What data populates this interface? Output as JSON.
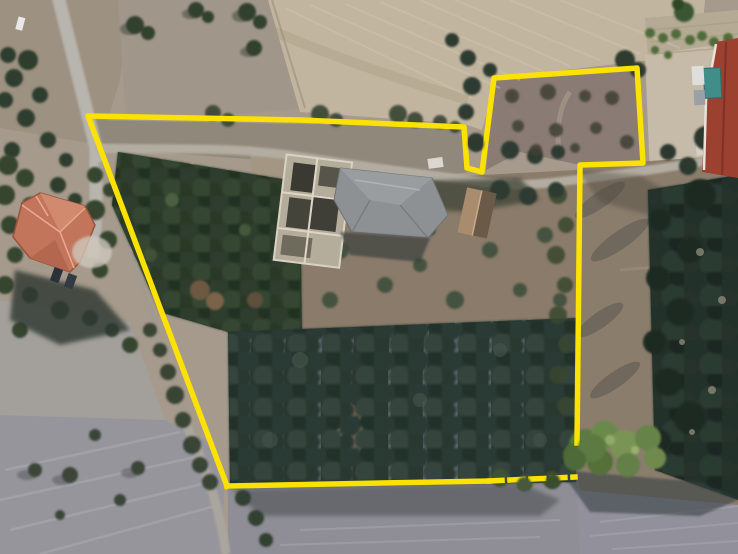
{
  "scene": {
    "type": "aerial-satellite-photo",
    "title": "Aerial view of rural land parcel with yellow boundary overlay",
    "width_px": 738,
    "height_px": 554
  },
  "boundary": {
    "color": "#fbe204",
    "stroke_width": 5.5,
    "dash_pattern": "13 8",
    "main_points": "227,486 88,116 300,120 464,127 467,168 482,172 494,78 637,68 643,163 580,165 577,443",
    "bottom_points": "227,486 489,481",
    "bottom_obscured_points": "489,481 575,477"
  },
  "features": {
    "house": {
      "label": "terracotta-roof-house",
      "roof_color": "#c3755b"
    },
    "ruin": {
      "label": "ruined-stone-building",
      "wall_color": "#b5ad9c"
    },
    "barn": {
      "label": "grey-hip-roof-building",
      "roof_color": "#8e9194"
    },
    "outbuilding": {
      "label": "small-tan-roof-outbuilding",
      "roof_color": "#a98c6d"
    },
    "corner_building": {
      "label": "red-roof-building-top-right",
      "roof_color": "#9c4030"
    },
    "container": {
      "label": "teal-container",
      "color": "#418d89"
    },
    "olive_grove": {
      "label": "olive-grove",
      "canopy_color": "#2e3b36"
    },
    "plowed_field": {
      "label": "plowed-beige-field",
      "color": "#c2b5a0"
    },
    "roads": {
      "label": "dirt-roads",
      "color": "#b6b3ad"
    }
  }
}
